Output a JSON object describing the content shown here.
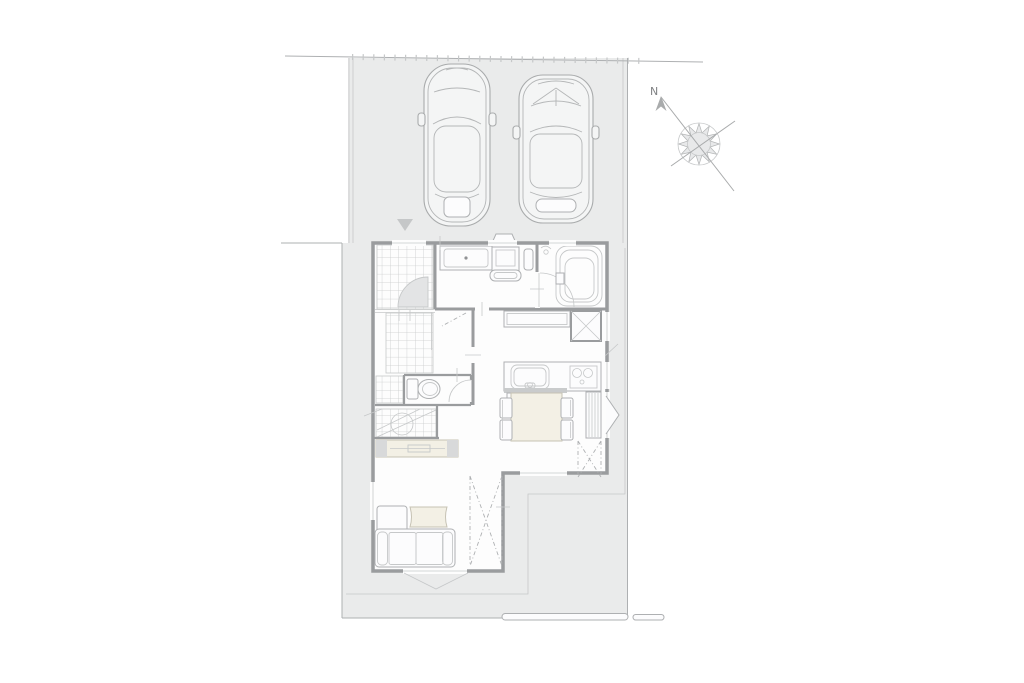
{
  "compass": {
    "north_label": "N"
  },
  "colors": {
    "page_bg": "#ffffff",
    "site_fill": "#eaebeb",
    "house_fill": "#fdfdfd",
    "wall": "#9a9c9e",
    "line": "#aeb0b2",
    "line_light": "#c6c8c9",
    "grid_line": "#c9cbcc",
    "beige_fill": "#f3f0e5",
    "beige_stroke": "#c6c2b4",
    "door_fill": "#e3e4e5",
    "marker_fill": "#c5c7c8",
    "car_fill": "#f4f5f5",
    "counter_bar": "#c9cbcc"
  },
  "plan": {
    "site": {
      "areas": [
        {
          "name": "parking-area"
        },
        {
          "name": "yard-area"
        }
      ],
      "vehicles": [
        {
          "name": "car-1"
        },
        {
          "name": "car-2"
        }
      ],
      "markers": [
        {
          "name": "approach-triangle-marker"
        },
        {
          "name": "north-compass"
        }
      ]
    },
    "house": {
      "rooms": [
        {
          "name": "entrance-porch"
        },
        {
          "name": "washroom"
        },
        {
          "name": "bathroom"
        },
        {
          "name": "toilet-room"
        },
        {
          "name": "staircase"
        },
        {
          "name": "kitchen-dining"
        },
        {
          "name": "living-room"
        }
      ],
      "fixtures": [
        {
          "name": "entrance-door-swing"
        },
        {
          "name": "washbasin-counter"
        },
        {
          "name": "washing-machine"
        },
        {
          "name": "bathtub"
        },
        {
          "name": "bathroom-door-swing"
        },
        {
          "name": "toilet"
        },
        {
          "name": "toilet-door-swing"
        },
        {
          "name": "storage-counter"
        },
        {
          "name": "crossed-box-closet"
        },
        {
          "name": "kitchen-sink"
        },
        {
          "name": "cooktop"
        },
        {
          "name": "dining-table"
        },
        {
          "name": "dining-chair",
          "count": 4
        },
        {
          "name": "tv-board"
        },
        {
          "name": "sofa"
        },
        {
          "name": "coffee-table"
        },
        {
          "name": "bay-window-marker",
          "count": 2
        },
        {
          "name": "louver-window"
        },
        {
          "name": "dashed-brace-area",
          "count": 2
        }
      ]
    }
  }
}
